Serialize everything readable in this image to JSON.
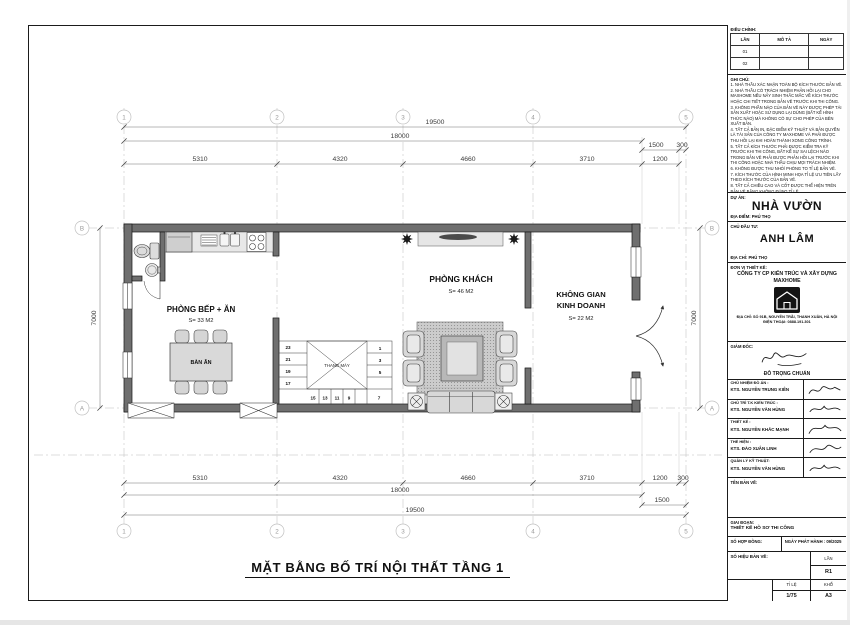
{
  "plan": {
    "title": "MẶT BẰNG BỐ TRÍ NỘI THẤT TẦNG 1",
    "rooms": {
      "kitchen": {
        "name": "PHÒNG BẾP + ĂN",
        "area": "S= 33 M2"
      },
      "living": {
        "name": "PHÒNG KHÁCH",
        "area": "S= 46 M2"
      },
      "business": {
        "name_lines": [
          "KHÔNG GIAN",
          "KINH DOANH"
        ],
        "area": "S= 22 M2"
      }
    },
    "furniture": {
      "dining_table": "BÀN ĂN",
      "elevator": "THANG MÁY"
    },
    "stairs": {
      "left": [
        "23",
        "21",
        "19",
        "17"
      ],
      "right": [
        "1",
        "3",
        "5"
      ],
      "bottom": [
        "15",
        "13",
        "11",
        "9"
      ],
      "corner": "7"
    },
    "dims": {
      "overall": "19500",
      "main": "18000",
      "porch": "1500",
      "edge": "300",
      "segments": [
        "5310",
        "4320",
        "4660",
        "3710",
        "1200"
      ],
      "height": "7000"
    },
    "grid": {
      "cols": [
        "1",
        "2",
        "3",
        "4",
        "5"
      ],
      "row_top": "B",
      "row_bottom": "A"
    }
  },
  "title_block": {
    "revision": {
      "title": "ĐIỀU CHỈNH:",
      "columns": [
        "LẦN",
        "MÔ TẢ",
        "NGÀY"
      ],
      "rows": [
        [
          "01",
          "",
          ""
        ],
        [
          "02",
          "",
          ""
        ]
      ]
    },
    "notes_title": "GHI CHÚ:",
    "notes": [
      "1. NHÀ THẦU XÁC NHẬN TOÀN BỘ KÍCH THƯỚC BẢN VẼ.",
      "2. NHÀ THẦU CÓ TRÁCH NHIỆM PHẢN HỒI LẠI CHO MAXHOME NẾU NẢY SINH THẮC MẮC VỀ KÍCH THƯỚC HOẶC CHI TIẾT TRONG BẢN VẼ TRƯỚC KHI THI CÔNG.",
      "3. KHÔNG PHẦN NÀO CỦA BẢN VẼ NÀY ĐƯỢC PHÉP TÁI SẢN XUẤT HOẶC SỬ DỤNG LẠI DÙNG (BẤT KỂ HÌNH THỨC NÀO) MÀ KHÔNG CÓ SỰ CHO PHÉP CỦA BÊN XUẤT BẢN.",
      "4. TẤT CẢ BẢN IN, ĐẶC ĐIỂM KỸ THUẬT VÀ BẢN QUYỀN LÀ TÀI SẢN CỦA CÔNG TY MAXHOME VÀ PHẢI ĐƯỢC THU HỒI LẠI KHI HOÀN THÀNH XONG CÔNG TRÌNH.",
      "5. TẤT CẢ KÍCH THƯỚC PHẢI ĐƯỢC KIỂM TRA KỸ TRƯỚC KHI THI CÔNG, BẤT KỂ SỰ SAI LỆCH NÀO TRONG BẢN VẼ PHẢI ĐƯỢC PHẢN HỒI LẠI TRƯỚC KHI THI CÔNG HOẶC NHÀ THẦU CHỊU MỌI TRÁCH NHIỆM.",
      "6. KHÔNG ĐƯỢC THU NHỎ/ PHÓNG TO TỈ LỆ BẢN VẼ.",
      "7. KÍCH THƯỚC CỦA HÌNH MINH HỌA TỈ LỆ ƯU TIÊN LẤY THEO KÍCH THƯỚC CỦA BẢN VẼ.",
      "8. TẤT CẢ CHIỀU CAO VÀ CỐT ĐƯỢC THỂ HIỆN TRÊN BẢN VẼ BẰNG KHÔNG ĐÚNG TỈ LỆ.",
      "9. CÁC HẠNG MỤC HOÀN THIỆN, THI CÔNG NỘI THẤT NHÀ THẦU PHẢI KIỂM TRA KÍCH THƯỚC THỰC TẾ TẠI CÔNG TRÌNH TRƯỚC KHI THI CÔNG."
    ],
    "project": {
      "label": "DỰ ÁN:",
      "name": "NHÀ VƯỜN",
      "location": "ĐỊA ĐIỂM: PHÚ THỌ"
    },
    "client": {
      "label": "CHỦ ĐẦU TƯ:",
      "name": "ANH LÂM",
      "address": "ĐỊA CHỈ: PHÚ THỌ"
    },
    "designer": {
      "label": "ĐƠN VỊ THIẾT KẾ:",
      "company": "CÔNG TY CP KIẾN TRÚC VÀ XÂY DỰNG",
      "brand": "MAXHOME",
      "address": "ĐỊA CHỈ: SỐ 91B, NGUYỄN TRÃI, THANH XUÂN, HÀ NỘI",
      "phone": "ĐIỆN THOẠI: 0888.191.301"
    },
    "director": {
      "label": "GIÁM ĐỐC:",
      "name": "ĐỖ TRỌNG CHUẨN"
    },
    "staff": [
      {
        "role": "CHỦ NHIỆM ĐỒ ÁN :",
        "name": "KTS. NGUYỄN TRUNG KIÊN"
      },
      {
        "role": "CHỦ TRÌ T.K KIẾN TRÚC :",
        "name": "KTS. NGUYỄN VĂN HÙNG"
      },
      {
        "role": "THIẾT KẾ :",
        "name": "KTS. NGUYỄN KHẮC MẠNH"
      },
      {
        "role": "THỂ HIỆN :",
        "name": "KTS. ĐÀO XUÂN LINH"
      },
      {
        "role": "QUẢN LÝ KỸ THUẬT:",
        "name": "KTS. NGUYỄN VĂN HÙNG"
      }
    ],
    "drawing_name_label": "TÊN BẢN VẼ:",
    "phase": {
      "label": "GIAI ĐOẠN:",
      "value": "THIẾT KẾ HỒ SƠ THI CÔNG"
    },
    "contract": {
      "label": "SỐ HỢP ĐỒNG:",
      "issue": "NGÀY PHÁT HÀNH : 09/2025"
    },
    "sheet": {
      "number_label": "SỐ HIỆU BẢN VẼ:",
      "rev_label": "LẦN",
      "rev": "R1",
      "scale_label": "TỈ LỆ",
      "scale": "1/75",
      "size_label": "KHỔ",
      "size": "A3"
    }
  }
}
